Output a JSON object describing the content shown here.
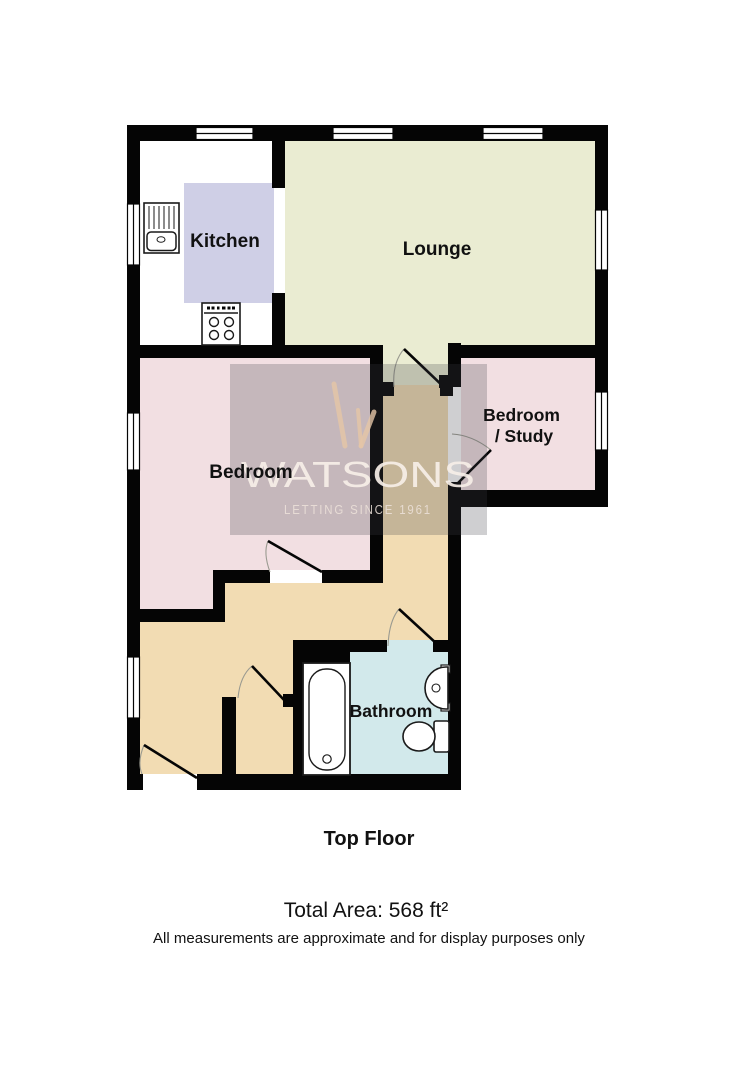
{
  "floorplan": {
    "floor_title": "Top Floor",
    "total_area": "Total Area: 568 ft²",
    "disclaimer": "All measurements are approximate and for display purposes only",
    "rooms": [
      {
        "label": "Kitchen",
        "color": "#ffffff"
      },
      {
        "label": "Lounge",
        "color": "#eaecd2"
      },
      {
        "label": "Bedroom",
        "color": "#f2dfe2"
      },
      {
        "label": "Bedroom / Study",
        "lines": [
          "Bedroom",
          "/ Study"
        ],
        "color": "#f2dfe2"
      },
      {
        "label": "Bathroom",
        "color": "#d2e9eb"
      },
      {
        "label": "Hallway",
        "color": "#f2dcb3"
      }
    ],
    "fixtures": [
      "kitchen-sink",
      "stove",
      "bathtub",
      "basin",
      "toilet"
    ],
    "window_count": 8,
    "door_count": 6,
    "colors": {
      "wall": "#050505",
      "kitchen_island": "#cfcfe6",
      "lounge": "#eaecd2",
      "bedroom": "#f2dfe2",
      "hallway": "#f2dcb3",
      "bathroom": "#d2e9eb",
      "watermark_overlay": "rgba(64,62,70,0.25)",
      "watermark_logo": "#e5c6a6"
    }
  },
  "watermark": {
    "brand": "WATSONS",
    "tagline": "LETTING SINCE 1961"
  }
}
